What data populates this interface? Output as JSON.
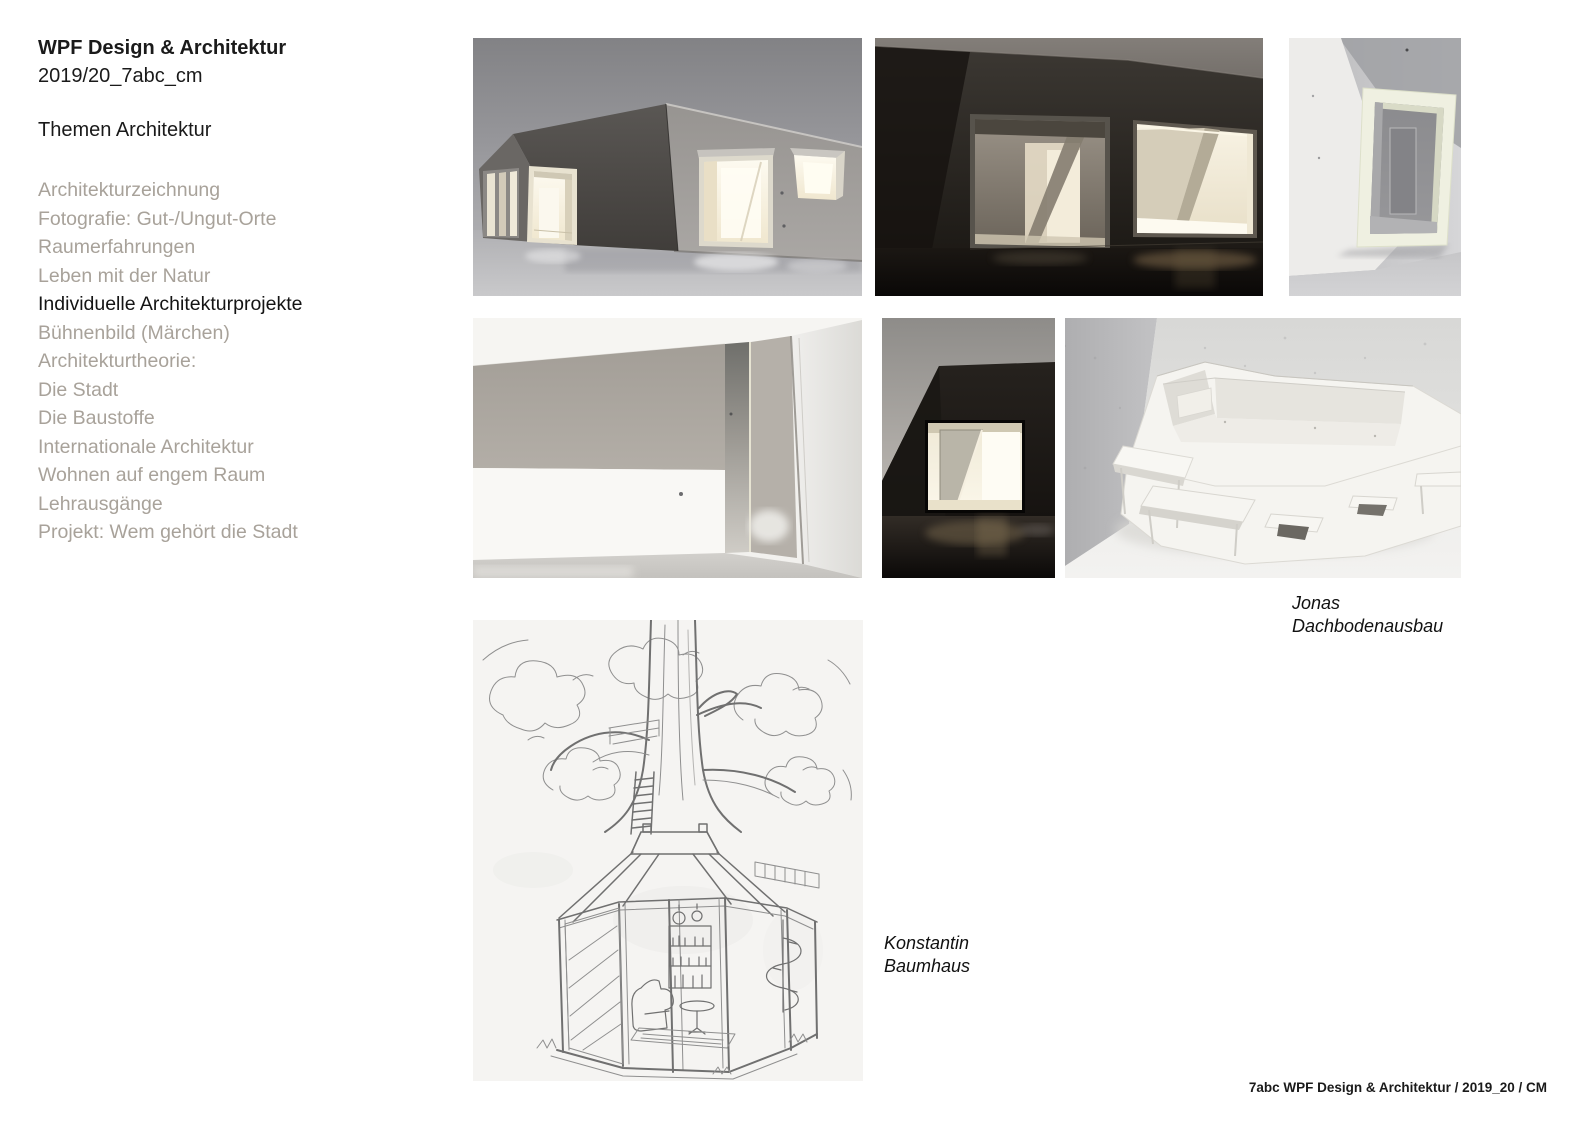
{
  "slide": {
    "header": {
      "title": "WPF Design & Architektur",
      "subtitle": "2019/20_7abc_cm",
      "section_label": "Themen Architektur"
    },
    "menu": {
      "items": [
        {
          "label": "Architekturzeichnung",
          "active": false
        },
        {
          "label": "Fotografie: Gut-/Ungut-Orte",
          "active": false
        },
        {
          "label": "Raumerfahrungen",
          "active": false
        },
        {
          "label": "Leben mit der Natur",
          "active": false
        },
        {
          "label": "Individuelle Architekturprojekte",
          "active": true
        },
        {
          "label": "Bühnenbild (Märchen)",
          "active": false
        },
        {
          "label": "Architekturtheorie:",
          "active": false
        },
        {
          "label": "Die Stadt",
          "active": false
        },
        {
          "label": "Die Baustoffe",
          "active": false
        },
        {
          "label": "Internationale Architektur",
          "active": false
        },
        {
          "label": "Wohnen auf engem Raum",
          "active": false
        },
        {
          "label": "Lehrausgänge",
          "active": false
        },
        {
          "label": "Projekt: Wem gehört die Stadt",
          "active": false
        }
      ]
    },
    "captions": {
      "jonas": {
        "line1": "Jonas",
        "line2": "Dachbodenausbau"
      },
      "konstantin": {
        "line1": "Konstantin",
        "line2": "Baumhaus"
      }
    },
    "footer": {
      "text": "7abc WPF Design & Architektur / 2019_20 / CM"
    },
    "gallery": [
      {
        "id": "model-exterior-wide",
        "kind": "photo",
        "description": "Architekturmodell – Außenansicht mit beleuchteten Öffnungen"
      },
      {
        "id": "model-night-closeup",
        "kind": "photo",
        "description": "Architekturmodell – dunkle Nahaufnahme mit zwei beleuchteten Fenstern"
      },
      {
        "id": "model-window-frame",
        "kind": "photo",
        "description": "Architekturmodell – weißes Fensterrahmen-Detail"
      },
      {
        "id": "model-interior",
        "kind": "photo",
        "description": "Architekturmodell – Innenraum in Weiß und Grau"
      },
      {
        "id": "model-dark-window",
        "kind": "photo",
        "description": "Architekturmodell – Silhouette mit leuchtendem Fenster"
      },
      {
        "id": "model-white-attic",
        "kind": "photo",
        "description": "Weißes Papiermodell – Dachbodenausbau in Zimmerecke"
      },
      {
        "id": "sketch-treehouse",
        "kind": "drawing",
        "description": "Bleistiftzeichnung – Baumhaus mit Baumstamm und verglastem Pavillon"
      }
    ],
    "colors": {
      "background": "#ffffff",
      "menu_inactive": "#a8a29a",
      "menu_active": "#141414",
      "caption_text": "#111111",
      "warm_light": "#f6efdc"
    }
  }
}
